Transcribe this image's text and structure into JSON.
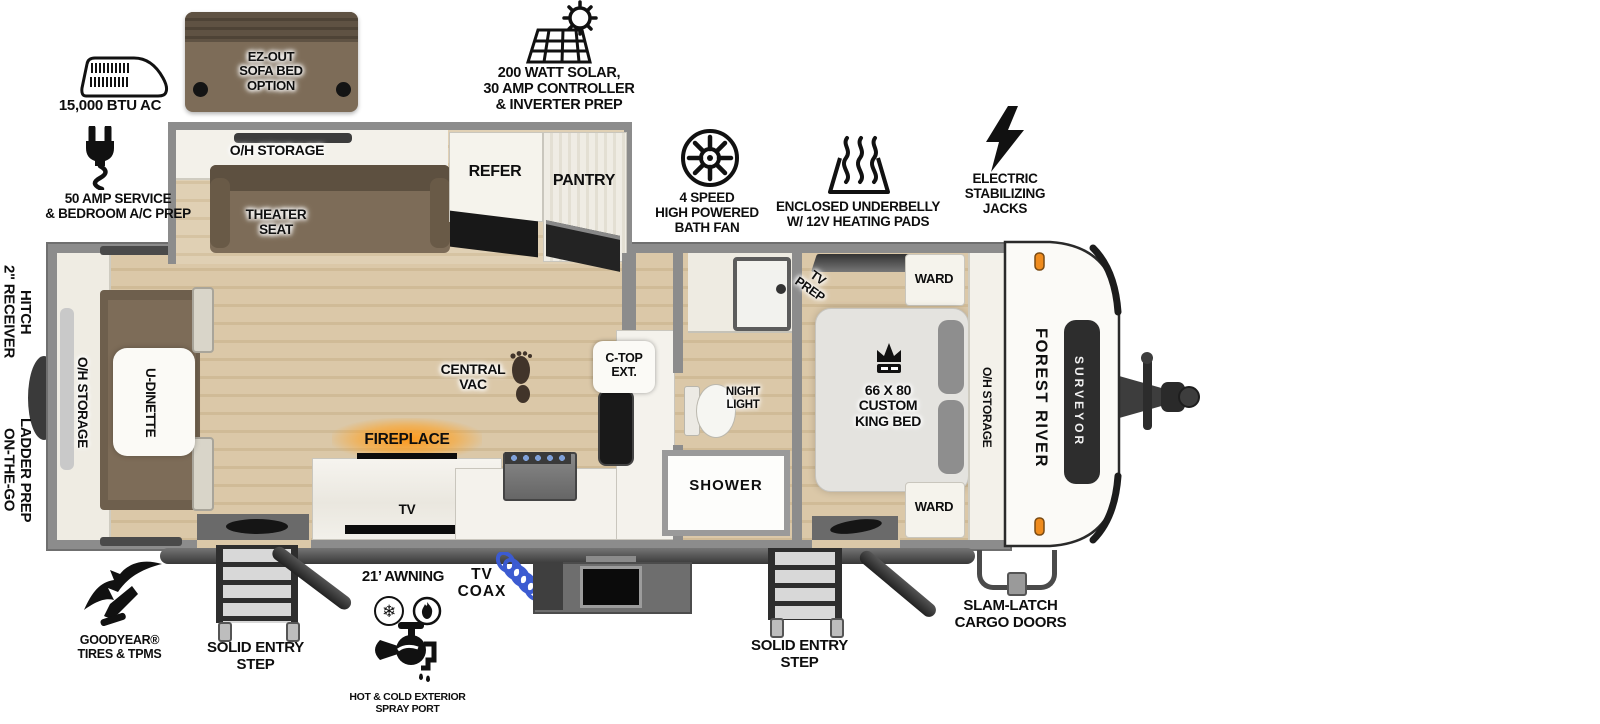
{
  "exterior": {
    "top": {
      "ac_label": "15,000 BTU AC",
      "sofa_option_label": "EZ-OUT\nSOFA BED\nOPTION",
      "solar_label": "200 WATT SOLAR,\n30 AMP CONTROLLER\n& INVERTER PREP",
      "service_label": "50 AMP SERVICE\n& BEDROOM A/C PREP",
      "bath_fan_label": "4 SPEED\nHIGH POWERED\nBATH FAN",
      "underbelly_label": "ENCLOSED UNDERBELLY\nW/ 12V HEATING PADS",
      "jacks_label": "ELECTRIC\nSTABILIZING\nJACKS"
    },
    "left": {
      "receiver_hitch_label": "2\" RECEIVER\nHITCH",
      "ladder_prep_label": "ON-THE-GO\nLADDER PREP"
    },
    "bottom": {
      "tires_label": "GOODYEAR®\nTIRES & TPMS",
      "entry_step_left_label": "SOLID ENTRY\nSTEP",
      "awning_label": "21’ AWNING",
      "spray_port_label": "HOT & COLD EXTERIOR\nSPRAY PORT",
      "tv_coax_label": "TV\nCOAX",
      "entry_step_right_label": "SOLID ENTRY\nSTEP",
      "cargo_doors_label": "SLAM-LATCH\nCARGO DOORS"
    }
  },
  "interior": {
    "slide_out": {
      "oh_storage": "O/H STORAGE",
      "theater_seat": "THEATER\nSEAT",
      "refer": "REFER",
      "pantry": "PANTRY"
    },
    "rear": {
      "oh_storage": "O/H STORAGE",
      "dinette": "U-DINETTE"
    },
    "living": {
      "central_vac": "CENTRAL\nVAC",
      "fireplace": "FIREPLACE",
      "tv": "TV"
    },
    "kitchen": {
      "ctop_ext": "C-TOP\nEXT."
    },
    "bath": {
      "night_light": "NIGHT\nLIGHT",
      "shower": "SHOWER"
    },
    "bedroom": {
      "tv_prep": "TV\nPREP",
      "ward_top": "WARD",
      "bed": "66 X 80\nCUSTOM\nKING BED",
      "ward_bottom": "WARD",
      "oh_storage": "O/H STORAGE"
    }
  },
  "branding": {
    "make": "FOREST RIVER",
    "model": "SURVEYOR"
  },
  "colors": {
    "wall": "#8c8c8c",
    "floor": "#d9c6a6",
    "furniture_brown": "#7d6c58",
    "furniture_dark": "#5d5040",
    "fireplace_glow": "#ffa21e",
    "marker_orange": "#ef8b1d",
    "coax_blue": "#3c5bd1",
    "step_dark": "#2e2e2e"
  }
}
